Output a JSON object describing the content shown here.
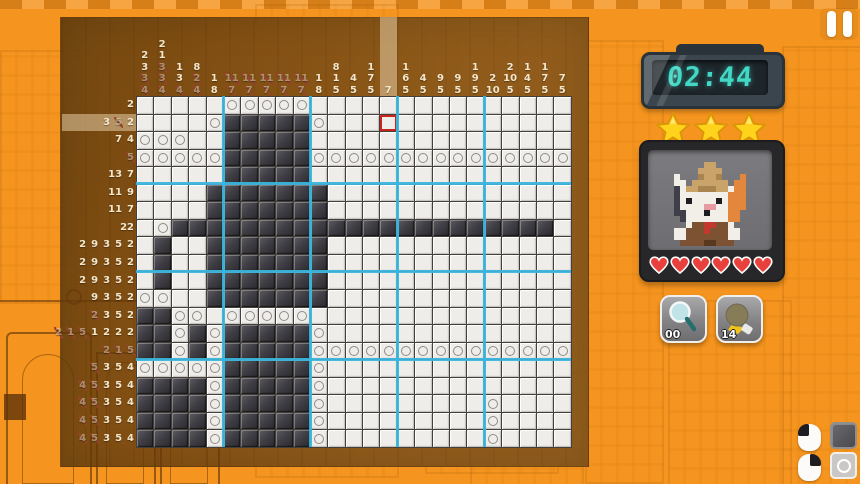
{
  "hud": {
    "timer": "02:44",
    "stars_count": 3,
    "hearts_count": 6
  },
  "powerups": [
    {
      "name": "magnifier",
      "icon": "magnifier-icon",
      "count": "00"
    },
    {
      "name": "hint-bulb",
      "icon": "bulb-icon",
      "count": "14"
    }
  ],
  "tool_legend": {
    "left_mouse": "fill-black-cell",
    "right_mouse": "mark-circle-cell"
  },
  "puzzle": {
    "cols": 25,
    "rows": 20,
    "col_clues": [
      [
        "2",
        "3",
        "3x",
        "4x"
      ],
      [
        "2",
        "1",
        "3x",
        "3x",
        "4x"
      ],
      [
        "1",
        "3",
        "4x"
      ],
      [
        "8",
        "2x",
        "4x"
      ],
      [
        "1",
        "8"
      ],
      [
        "11x",
        "7x"
      ],
      [
        "11x",
        "7x"
      ],
      [
        "11x",
        "7x"
      ],
      [
        "11x",
        "7x"
      ],
      [
        "11x",
        "7x"
      ],
      [
        "1",
        "8"
      ],
      [
        "8",
        "1",
        "5"
      ],
      [
        "4",
        "5"
      ],
      [
        "1",
        "7",
        "5"
      ],
      [
        "7"
      ],
      [
        "1",
        "6",
        "5"
      ],
      [
        "4",
        "5"
      ],
      [
        "9",
        "5"
      ],
      [
        "9",
        "5"
      ],
      [
        "1",
        "9",
        "5"
      ],
      [
        "2",
        "10"
      ],
      [
        "2",
        "10",
        "5"
      ],
      [
        "1",
        "4",
        "5"
      ],
      [
        "1",
        "7",
        "5"
      ],
      [
        "7",
        "5"
      ]
    ],
    "row_clues": [
      [
        "2"
      ],
      [
        "3",
        "5x",
        "2"
      ],
      [
        "7",
        "4"
      ],
      [
        "5x"
      ],
      [
        "13",
        "7"
      ],
      [
        "11",
        "9"
      ],
      [
        "11",
        "7"
      ],
      [
        "22"
      ],
      [
        "2",
        "9",
        "3",
        "5",
        "2"
      ],
      [
        "2",
        "9",
        "3",
        "5",
        "2"
      ],
      [
        "2",
        "9",
        "3",
        "5",
        "2"
      ],
      [
        "9",
        "3",
        "5",
        "2"
      ],
      [
        "2x",
        "3",
        "5",
        "2"
      ],
      [
        "2x",
        "1x",
        "5x",
        "1",
        "2",
        "2",
        "2"
      ],
      [
        "2x",
        "1x",
        "5x"
      ],
      [
        "5x",
        "3",
        "5",
        "4"
      ],
      [
        "4x",
        "5x",
        "3",
        "5",
        "4"
      ],
      [
        "4x",
        "5x",
        "3",
        "5",
        "4"
      ],
      [
        "4x",
        "5x",
        "3",
        "5",
        "4"
      ],
      [
        "4x",
        "5x",
        "3",
        "5",
        "4"
      ]
    ],
    "cells": [
      ".....OOOOO...............",
      "....OBBBBBO..............",
      "OOO..BBBBB...............",
      "OOOOOBBBBBOOOOOOOOOOOOOOO",
      ".....BBBBB...............",
      "....BBBBBBB..............",
      "....BBBBBBB..............",
      ".OBBBBBBBBBBBBBBBBBBBBBB.",
      ".B..BBBBBBB..............",
      ".B..BBBBBBB..............",
      ".B..BBBBBBB..............",
      "OO..BBBBBBB..............",
      "BBOO.OOOOO...............",
      "BBOBOBBBBBO..............",
      "BBOBOBBBBBOOOOOOOOOOOOOOO",
      "OOOOOBBBBBO..............",
      "BBBBOBBBBBO..............",
      "BBBBOBBBBBO.........O....",
      "BBBBOBBBBBO.........O....",
      "BBBBOBBBBBO.........O...."
    ],
    "cursor": {
      "row": 2,
      "col": 15
    },
    "highlighted_row": 2,
    "highlighted_col": 15
  },
  "portrait": {
    "pixels": [
      "......TT......",
      ".....TTTT.....",
      ".W...tTTt...O.",
      ".WW.TTTTTT.OO.",
      ".DWTTtttTTWOO.",
      ".DWWWWWWWWOOO.",
      ".DWPWWWWPWOOO.",
      ".DWWWWppWWOOO.",
      ".DDWWWPWWWOO..",
      "..DWWWWWWWOO..",
      "...WBBRRBBW...",
      ".WWBBBRBBBWW..",
      ".WWBBBBBBBWW..",
      "..BBBBbbBBB..."
    ],
    "palette": {
      "T": "#C9A36A",
      "t": "#A8854E",
      "W": "#F2EFE9",
      "O": "#E2873B",
      "D": "#3F3F49",
      "P": "#1D1D22",
      "p": "#E89AA2",
      "R": "#C2382F",
      "B": "#7D5233",
      "b": "#5A381F"
    }
  },
  "colors": {
    "background": "#F5941E",
    "board_brown": "#82551A",
    "grid_line_blue": "#3CB5DC",
    "cursor_red": "#C9251D",
    "clock_digits": "#41D8C5",
    "star_gold": "#FFD21C",
    "heart_red": "#E8403C"
  }
}
